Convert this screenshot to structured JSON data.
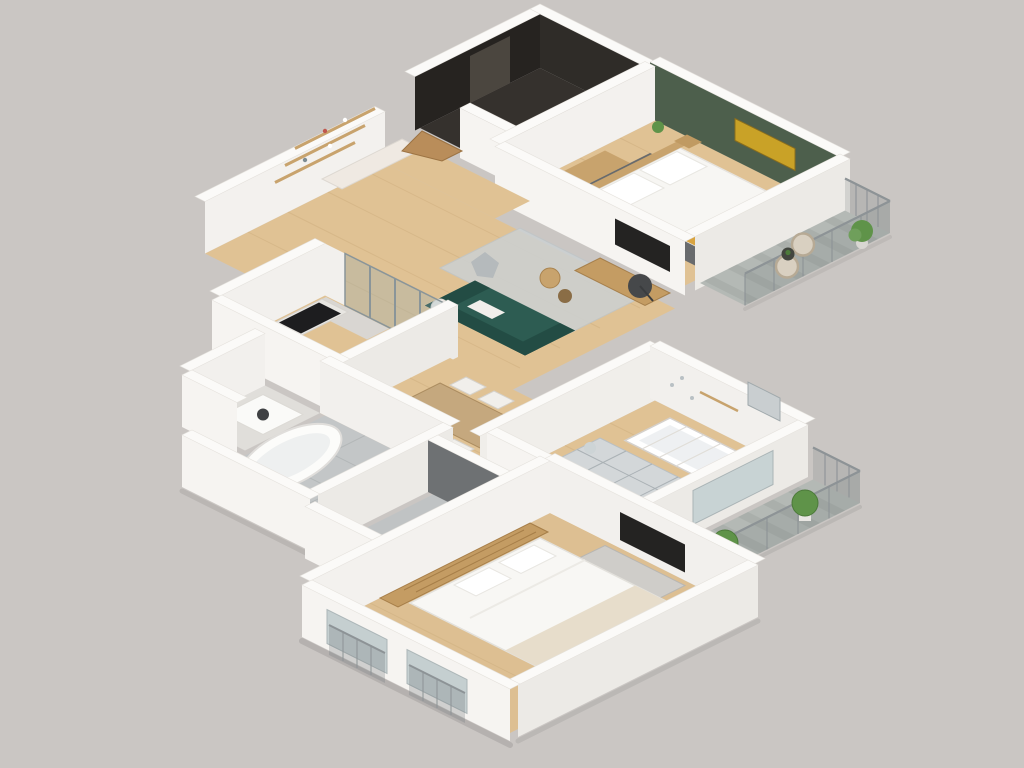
{
  "meta": {
    "type": "isometric-3d-floor-plan-render",
    "view": "top-down isometric cutaway of a furnished apartment",
    "visible_text": "none"
  },
  "palette": {
    "bg": "#cac6c3",
    "wall-top": "#fbfaf8",
    "wall-face-ne": "#f2f0ed",
    "wall-face-nw": "#f3f1ee",
    "wall-face-se": "#eceae6",
    "wall-face-sw": "#f6f4f1",
    "floor-wood": "#e0c294",
    "floor-wood-deep": "#ddbf92",
    "plank": "#cdae7e",
    "entry-floor": "#35312d",
    "entry-wall": "#2f2c28",
    "green-wall": "#4d5f4c",
    "art-gold": "#c9a227",
    "sofa-teal": "#2d5c52",
    "sofa-teal-dark": "#234c44",
    "mustard": "#d9a441",
    "rug-gray": "#ccd1d3",
    "rug-dark": "#62666a",
    "deck": "#b4b9b5",
    "deck-stripe": "#a7aca8",
    "tile": "#c3c6c7",
    "tile-line": "#b0b4b5",
    "wood-furn": "#c49c63",
    "wood-furn2": "#c8a36d",
    "white-furn": "#f3f1ee",
    "plant": "#5f9349",
    "plant-dark": "#4c7a3a",
    "rail": "#8d9396",
    "glass": "rgba(150,175,180,0.32)",
    "tv-dark": "#242322",
    "wc-wall": "#6e7173",
    "gray-unit": "#cfcdc9",
    "wicker": "#d9d0c1"
  },
  "scene": {
    "rooms": [
      {
        "name": "entry-hall",
        "floor": "dark",
        "features": [
          "dark-painted-walls",
          "door",
          "shoe-cabinet"
        ]
      },
      {
        "name": "bedroom-green",
        "floor": "wood",
        "features": [
          "green-accent-wall",
          "gold-artwork",
          "double-bed-mustard-throw",
          "headboard",
          "nightstands",
          "dresser",
          "dark-rug",
          "plant"
        ]
      },
      {
        "name": "balcony-top",
        "floor": "deck",
        "features": [
          "railing",
          "two-wicker-chairs",
          "side-table",
          "potted-plant"
        ]
      },
      {
        "name": "living-room",
        "floor": "wood",
        "features": [
          "wall-shelves",
          "sideboard",
          "bookshelf",
          "butterfly-chair",
          "gray-rug",
          "teal-sofa",
          "coffee-tables",
          "tv-console",
          "wall-tv",
          "floor-lamp",
          "floor-cushion"
        ]
      },
      {
        "name": "kitchen",
        "floor": "wood",
        "features": [
          "counter",
          "black-cooktop",
          "sink",
          "tall-cabinet",
          "island-cart",
          "glass-partition"
        ]
      },
      {
        "name": "dining-area",
        "floor": "wood",
        "features": [
          "wood-table",
          "six-white-chairs",
          "white-sideboard"
        ]
      },
      {
        "name": "nursery",
        "floor": "wood",
        "features": [
          "white-crib",
          "changing-dresser",
          "diamond-rug",
          "pouf",
          "wall-window"
        ]
      },
      {
        "name": "balcony-right",
        "floor": "deck",
        "features": [
          "railing",
          "two-green-bushes-in-pots"
        ]
      },
      {
        "name": "utility-room",
        "floor": "gray",
        "features": [
          "washing-machine"
        ]
      },
      {
        "name": "bathroom",
        "floor": "tile",
        "features": [
          "freestanding-tub",
          "ladder-shelf",
          "sink-counter"
        ]
      },
      {
        "name": "wc",
        "floor": "tile",
        "features": [
          "dark-gray-wall",
          "toilet"
        ]
      },
      {
        "name": "bedroom-master",
        "floor": "wood",
        "features": [
          "double-bed-white",
          "headboard-shelf-wall",
          "tv-stand",
          "wall-tv",
          "bench",
          "wardrobe",
          "french-windows-with-railings"
        ]
      }
    ]
  }
}
